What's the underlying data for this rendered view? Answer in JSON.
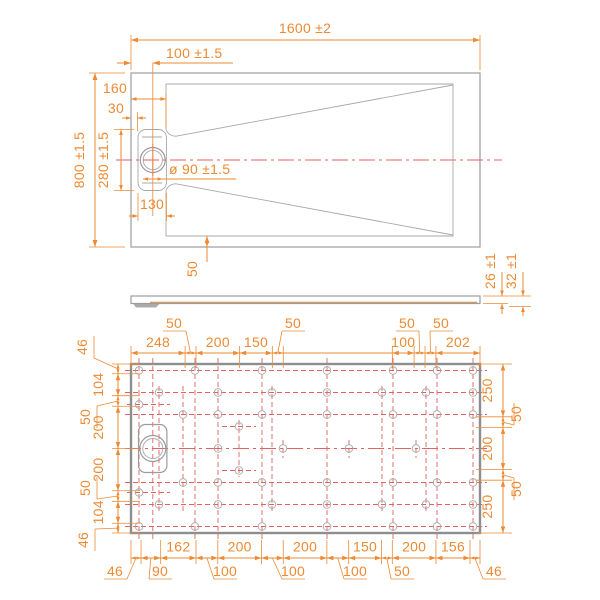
{
  "colors": {
    "dimension": "#ED8A33",
    "centerline_red": "#E06262",
    "outline_gray": "#9C9C9C",
    "border_gray": "#8E8E8E",
    "surface_tan": "#C9996B"
  },
  "top_view": {
    "dims": {
      "overall_width": "1600 ±2",
      "drain_offset": "100 ±1.5",
      "edge_to_floor": "160",
      "rim_thickness": "30",
      "overall_depth": "800 ±1.5",
      "recess_length": "280 ±1.5",
      "drain_diameter": "ø 90 ±1.5",
      "recess_width": "130",
      "floor_margin": "50"
    }
  },
  "side_view": {
    "dims": {
      "edge_height": "26 ±1",
      "total_height": "32 ±1"
    }
  },
  "bottom_view": {
    "chains": {
      "top": [
        {
          "label": "248",
          "mm": 248,
          "style": "inline"
        },
        {
          "label": "50",
          "mm": 50,
          "style": "leader"
        },
        {
          "label": "200",
          "mm": 200,
          "style": "inline"
        },
        {
          "label": "150",
          "mm": 150,
          "style": "inline"
        },
        {
          "label": "50",
          "mm": 50,
          "style": "leader"
        },
        {
          "label": "",
          "mm": 500,
          "style": "none"
        },
        {
          "label": "100",
          "mm": 100,
          "style": "inline"
        },
        {
          "label": "50",
          "mm": 50,
          "style": "leader"
        },
        {
          "label": "50",
          "mm": 50,
          "style": "leader"
        },
        {
          "label": "202",
          "mm": 202,
          "style": "inline"
        }
      ],
      "left": [
        {
          "label": "46",
          "mm": 46,
          "style": "leader"
        },
        {
          "label": "104",
          "mm": 104,
          "style": "inline"
        },
        {
          "label": "50",
          "mm": 50,
          "style": "leader"
        },
        {
          "label": "200",
          "mm": 200,
          "style": "inline"
        },
        {
          "label": "200",
          "mm": 200,
          "style": "inline"
        },
        {
          "label": "50",
          "mm": 50,
          "style": "leader"
        },
        {
          "label": "104",
          "mm": 104,
          "style": "inline"
        },
        {
          "label": "46",
          "mm": 46,
          "style": "leader"
        }
      ],
      "right": [
        {
          "label": "250",
          "mm": 250,
          "style": "inline"
        },
        {
          "label": "50",
          "mm": 50,
          "style": "leader"
        },
        {
          "label": "200",
          "mm": 200,
          "style": "inline"
        },
        {
          "label": "50",
          "mm": 50,
          "style": "leader"
        },
        {
          "label": "250",
          "mm": 250,
          "style": "inline"
        }
      ],
      "bottom": [
        {
          "label": "46",
          "mm": 46,
          "style": "leader"
        },
        {
          "label": "90",
          "mm": 90,
          "style": "leader"
        },
        {
          "label": "162",
          "mm": 162,
          "style": "inline"
        },
        {
          "label": "100",
          "mm": 100,
          "style": "leader"
        },
        {
          "label": "200",
          "mm": 200,
          "style": "inline"
        },
        {
          "label": "100",
          "mm": 100,
          "style": "leader"
        },
        {
          "label": "200",
          "mm": 200,
          "style": "inline"
        },
        {
          "label": "100",
          "mm": 100,
          "style": "leader"
        },
        {
          "label": "150",
          "mm": 150,
          "style": "inline"
        },
        {
          "label": "50",
          "mm": 50,
          "style": "leader"
        },
        {
          "label": "200",
          "mm": 200,
          "style": "inline"
        },
        {
          "label": "156",
          "mm": 156,
          "style": "inline"
        },
        {
          "label": "46",
          "mm": 46,
          "style": "leader"
        }
      ]
    },
    "feet": [
      [
        139,
        370.5
      ],
      [
        195,
        370.5
      ],
      [
        262,
        370.5
      ],
      [
        327,
        370.5
      ],
      [
        393,
        370.5
      ],
      [
        437,
        370.5
      ],
      [
        473,
        370.5
      ],
      [
        159,
        392.5
      ],
      [
        218,
        392.5
      ],
      [
        272,
        392.5
      ],
      [
        327,
        392.5
      ],
      [
        382,
        392.5
      ],
      [
        426,
        392.5
      ],
      [
        473,
        392.5
      ],
      [
        139,
        404.5
      ],
      [
        183,
        414.5
      ],
      [
        218,
        414.5
      ],
      [
        262,
        414.5
      ],
      [
        327,
        414.5
      ],
      [
        393,
        414.5
      ],
      [
        437,
        414.5
      ],
      [
        473,
        414.5
      ],
      [
        239,
        426.5
      ],
      [
        218,
        448.5
      ],
      [
        283,
        448.5
      ],
      [
        349,
        448.5
      ],
      [
        416,
        448.5
      ],
      [
        239,
        470.5
      ],
      [
        183,
        482.5
      ],
      [
        218,
        482.5
      ],
      [
        262,
        482.5
      ],
      [
        327,
        482.5
      ],
      [
        393,
        482.5
      ],
      [
        437,
        482.5
      ],
      [
        473,
        482.5
      ],
      [
        139,
        492.5
      ],
      [
        159,
        504.5
      ],
      [
        218,
        504.5
      ],
      [
        272,
        504.5
      ],
      [
        327,
        504.5
      ],
      [
        382,
        504.5
      ],
      [
        426,
        504.5
      ],
      [
        473,
        504.5
      ],
      [
        139,
        526.5
      ],
      [
        195,
        526.5
      ],
      [
        262,
        526.5
      ],
      [
        327,
        526.5
      ],
      [
        393,
        526.5
      ],
      [
        437,
        526.5
      ],
      [
        473,
        526.5
      ]
    ],
    "grid": {
      "rows_long": [
        370.5,
        392.5,
        414.5,
        448.5,
        482.5,
        504.5,
        526.5
      ],
      "centerline_row": 448.5,
      "rows_x_range": [
        125,
        487
      ],
      "cols_long": [
        139,
        152.8,
        195,
        218,
        262,
        327,
        393,
        437,
        473
      ],
      "cols_y_range": [
        358,
        539
      ],
      "cols_mid": [
        159,
        183,
        272,
        382,
        426
      ],
      "cols_mid_range": [
        386,
        511
      ],
      "cols_extra": [
        {
          "x": 239,
          "y1": 420,
          "y2": 477
        },
        {
          "x": 283,
          "y1": 440,
          "y2": 458
        },
        {
          "x": 349,
          "y1": 440,
          "y2": 458
        },
        {
          "x": 416,
          "y1": 440,
          "y2": 458
        }
      ],
      "rows_short": [
        {
          "y": 404.5,
          "x1": 127,
          "x2": 170
        },
        {
          "y": 426.5,
          "x1": 222,
          "x2": 256
        },
        {
          "y": 470.5,
          "x1": 222,
          "x2": 256
        },
        {
          "y": 492.5,
          "x1": 127,
          "x2": 170
        }
      ]
    }
  }
}
